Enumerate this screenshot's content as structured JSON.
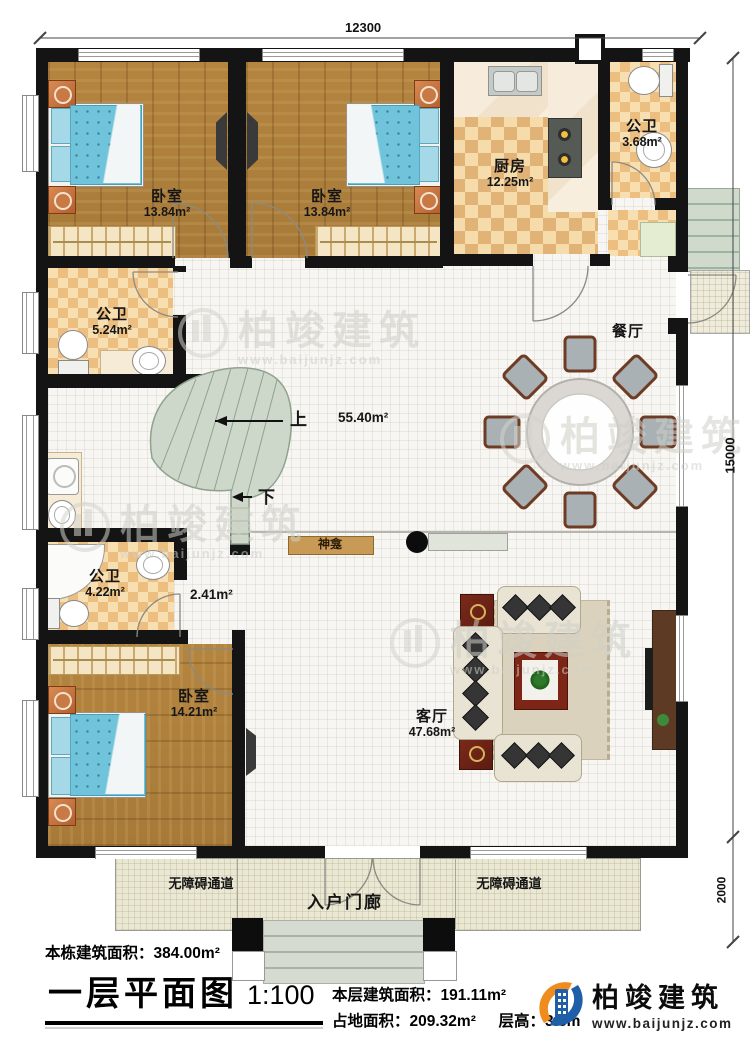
{
  "dimensions": {
    "top": "12300",
    "right": "15000",
    "porch": "2000"
  },
  "rooms": {
    "bedroom_tl": {
      "name": "卧室",
      "area": "13.84m²"
    },
    "bedroom_tm": {
      "name": "卧室",
      "area": "13.84m²"
    },
    "bedroom_bl": {
      "name": "卧室",
      "area": "14.21m²"
    },
    "kitchen": {
      "name": "厨房",
      "area": "12.25m²"
    },
    "bath_top": {
      "name": "公卫",
      "area": "3.68m²"
    },
    "bath_mid": {
      "name": "公卫",
      "area": "5.24m²"
    },
    "bath_low": {
      "name": "公卫",
      "area": "4.22m²"
    },
    "dining": {
      "name": "餐厅"
    },
    "living": {
      "name": "客厅",
      "area": "47.68m²"
    },
    "hall": {
      "area": "55.40m²"
    },
    "corridor": {
      "area": "2.41m²"
    }
  },
  "features": {
    "shrine": "神龛",
    "stair_up": "上",
    "stair_down": "下"
  },
  "porch": {
    "center": "入户门廊",
    "ramp_left": "无障碍通道",
    "ramp_right": "无障碍通道"
  },
  "title_block": {
    "total_area_label": "本栋建筑面积：",
    "total_area": "384.00m²",
    "title": "一层平面图",
    "scale": "1:100",
    "floor_area_label": "本层建筑面积：",
    "floor_area": "191.11m²",
    "land_area_label": "占地面积：",
    "land_area": "209.32m²",
    "height_label": "层高：",
    "height": "3.8m"
  },
  "logo": {
    "name": "柏竣建筑",
    "url": "www.baijunjz.com"
  },
  "watermark": {
    "text": "柏竣建筑",
    "url": "www.baijunjz.com"
  },
  "colors": {
    "accent_orange": "#f08c1e",
    "accent_blue": "#1f5fa8",
    "wall": "#141414",
    "stair_green": "#cdd8cb"
  }
}
